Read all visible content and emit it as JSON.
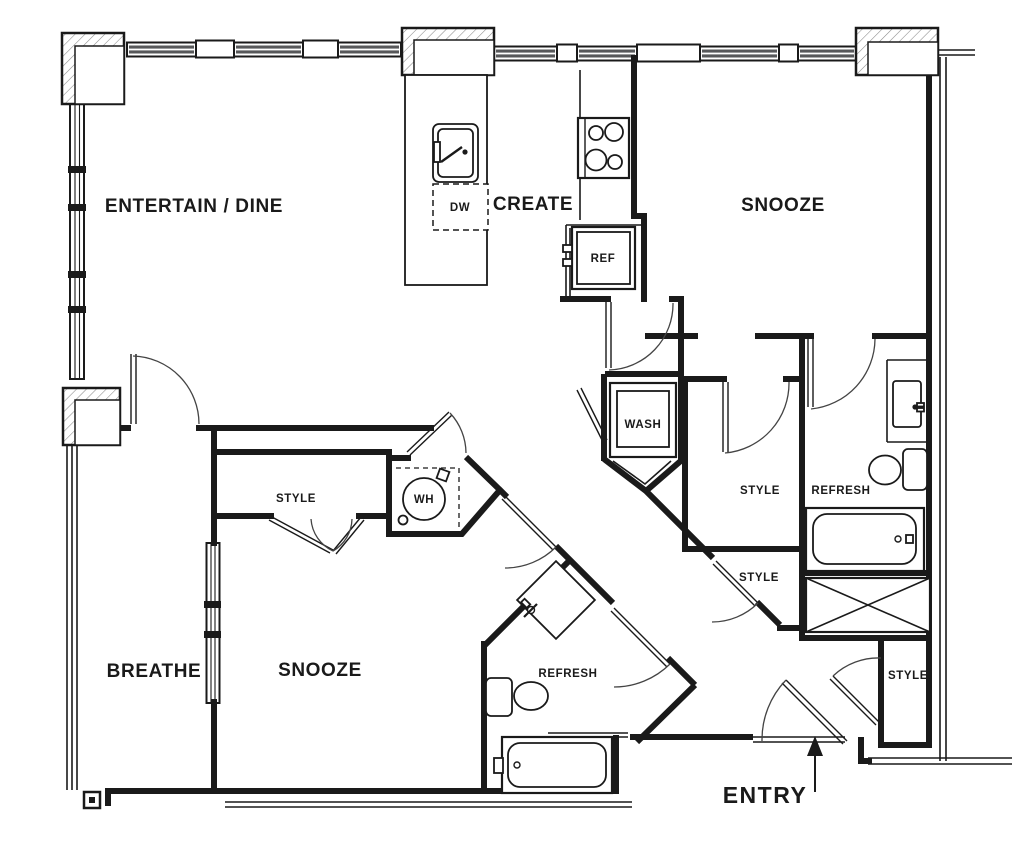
{
  "floor_plan": {
    "rooms": [
      {
        "id": "entertain-dine",
        "label": "ENTERTAIN / DINE"
      },
      {
        "id": "create",
        "label": "CREATE"
      },
      {
        "id": "snooze-main",
        "label": "SNOOZE"
      },
      {
        "id": "refresh-main",
        "label": "REFRESH"
      },
      {
        "id": "style-walkin",
        "label": "STYLE"
      },
      {
        "id": "style-linen",
        "label": "STYLE"
      },
      {
        "id": "style-entry",
        "label": "STYLE"
      },
      {
        "id": "snooze-second",
        "label": "SNOOZE"
      },
      {
        "id": "refresh-second",
        "label": "REFRESH"
      },
      {
        "id": "style-reachin",
        "label": "STYLE"
      },
      {
        "id": "breathe",
        "label": "BREATHE"
      }
    ],
    "appliances": [
      {
        "id": "dishwasher",
        "label": "DW"
      },
      {
        "id": "refrigerator",
        "label": "REF"
      },
      {
        "id": "washer",
        "label": "WASH"
      },
      {
        "id": "water-heater",
        "label": "WH"
      }
    ],
    "entry_label": "ENTRY",
    "colors": {
      "line": "#1a1a1a",
      "glazing": "#57585a",
      "background": "#ffffff"
    }
  }
}
